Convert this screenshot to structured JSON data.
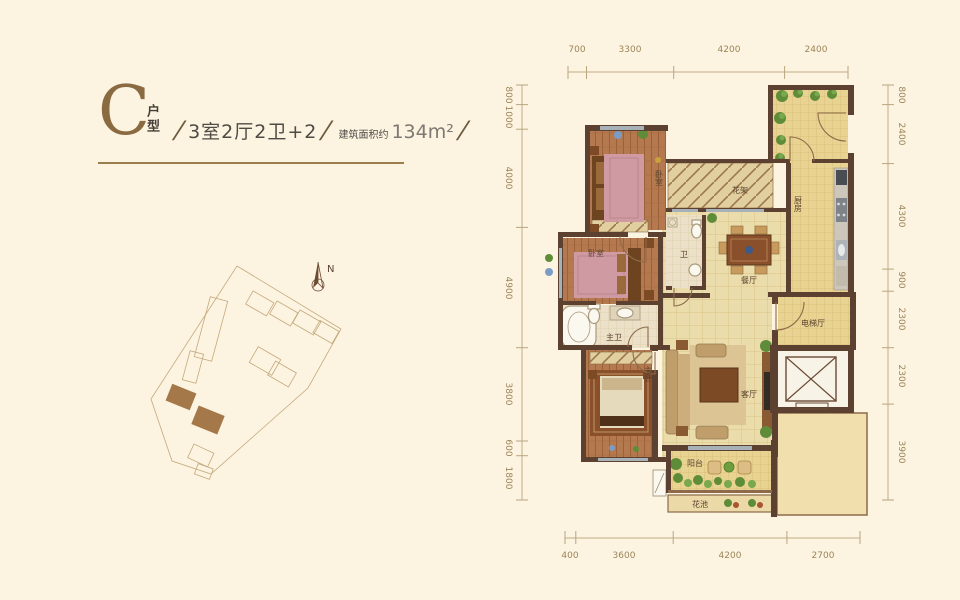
{
  "title": {
    "letter": "C",
    "type_label": "户型",
    "slash": "/",
    "spec": "3室2厅2卫+2",
    "area_label": "建筑面积约",
    "area_value": "134m²"
  },
  "compass": {
    "north": "N"
  },
  "dimensions": {
    "top": [
      "700",
      "3300",
      "4200",
      "2400"
    ],
    "bottom": [
      "400",
      "3600",
      "4200",
      "2700"
    ],
    "left": [
      "800",
      "1000",
      "4000",
      "4900",
      "3800",
      "600",
      "1800"
    ],
    "right": [
      "800",
      "2400",
      "4300",
      "900",
      "2300",
      "2300",
      "3900"
    ]
  },
  "rooms": {
    "bedroom_top": "卧室",
    "bedroom_mid": "卧室",
    "master_bedroom": "主卧",
    "master_bath": "主卫",
    "bath": "卫",
    "kitchen": "厨房",
    "dining": "餐厅",
    "living": "客厅",
    "pergola": "花架",
    "elevator_hall": "电梯厅",
    "balcony": "阳台",
    "flower_bed": "花池"
  },
  "colors": {
    "accent": "#8a6a41",
    "wall": "#5d4130",
    "dim_text": "#9c8659",
    "page_bg": "#fcf3e1"
  }
}
